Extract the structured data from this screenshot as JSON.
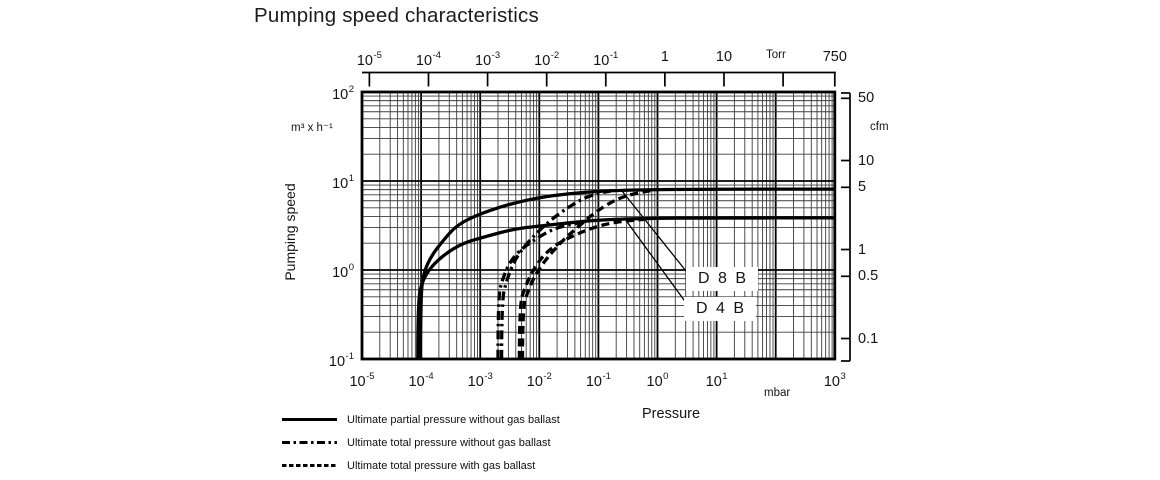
{
  "title": "Pumping speed characteristics",
  "axis_titles": {
    "x": "Pressure",
    "y": "Pumping speed"
  },
  "units": {
    "bottom": "mbar",
    "top": "Torr",
    "left": "m³ x h⁻¹",
    "right": "cfm"
  },
  "legend": {
    "items": [
      {
        "style": "solid",
        "label": "Ultimate partial pressure without gas ballast"
      },
      {
        "style": "dashdot",
        "label": "Ultimate total pressure without gas ballast"
      },
      {
        "style": "dotted",
        "label": "Ultimate total pressure with gas ballast"
      }
    ]
  },
  "chart_data": {
    "type": "line",
    "title": "Pumping speed characteristics",
    "xlabel": "Pressure",
    "ylabel": "Pumping speed",
    "x_scale": "log",
    "y_scale": "log",
    "x_range_mbar": [
      1e-05,
      1000
    ],
    "y_range_m3h": [
      0.1,
      100
    ],
    "grid": "log, major decades + minor lines",
    "x_axis_bottom": {
      "unit": "mbar",
      "ticks": [
        {
          "base": "10",
          "exp": "-5",
          "value": 1e-05
        },
        {
          "base": "10",
          "exp": "-4",
          "value": 0.0001
        },
        {
          "base": "10",
          "exp": "-3",
          "value": 0.001
        },
        {
          "base": "10",
          "exp": "-2",
          "value": 0.01
        },
        {
          "base": "10",
          "exp": "-1",
          "value": 0.1
        },
        {
          "base": "10",
          "exp": "0",
          "value": 1
        },
        {
          "base": "10",
          "exp": "1",
          "value": 10
        },
        {
          "base": "10",
          "exp": "3",
          "value": 1000
        }
      ]
    },
    "x_axis_top": {
      "unit": "Torr",
      "ticks": [
        {
          "base": "10",
          "exp": "-5",
          "value": 1e-05
        },
        {
          "base": "10",
          "exp": "-4",
          "value": 0.0001
        },
        {
          "base": "10",
          "exp": "-3",
          "value": 0.001
        },
        {
          "base": "10",
          "exp": "-2",
          "value": 0.01
        },
        {
          "base": "10",
          "exp": "-1",
          "value": 0.1
        },
        {
          "base": "1",
          "value": 1
        },
        {
          "base": "10",
          "value": 10
        },
        {
          "value": 100
        },
        {
          "base": "750",
          "value": 750
        }
      ]
    },
    "y_axis_left": {
      "unit": "m³ x h⁻¹",
      "ticks": [
        {
          "base": "10",
          "exp": "2",
          "value": 100
        },
        {
          "base": "10",
          "exp": "1",
          "value": 10
        },
        {
          "base": "10",
          "exp": "0",
          "value": 1
        },
        {
          "base": "10",
          "exp": "-1",
          "value": 0.1
        }
      ]
    },
    "y_axis_right": {
      "unit": "cfm",
      "ticks": [
        {
          "label": "50",
          "value": 50
        },
        {
          "label": "10",
          "value": 10
        },
        {
          "label": "5",
          "value": 5
        },
        {
          "label": "1",
          "value": 1
        },
        {
          "label": "0.5",
          "value": 0.5
        },
        {
          "label": "0.1",
          "value": 0.1
        }
      ]
    },
    "series": [
      {
        "name": "D 8 B ultimate partial pressure without gas ballast",
        "pump": "D 8 B",
        "style": "solid",
        "points_mbar_m3h": [
          [
            9.8e-05,
            0.1
          ],
          [
            9.8e-05,
            0.5
          ],
          [
            0.00011,
            0.93
          ],
          [
            0.00015,
            1.45
          ],
          [
            0.00023,
            2.1
          ],
          [
            0.0004,
            3.2
          ],
          [
            0.001,
            4.3
          ],
          [
            0.0031,
            5.5
          ],
          [
            0.012,
            6.7
          ],
          [
            0.048,
            7.4
          ],
          [
            0.23,
            7.9
          ],
          [
            5,
            8.1
          ],
          [
            1000,
            8.1
          ]
        ]
      },
      {
        "name": "D 4 B ultimate partial pressure without gas ballast",
        "pump": "D 4 B",
        "style": "solid",
        "points_mbar_m3h": [
          [
            8.8e-05,
            0.1
          ],
          [
            8.8e-05,
            0.45
          ],
          [
            0.000105,
            0.76
          ],
          [
            0.00015,
            1.1
          ],
          [
            0.00025,
            1.5
          ],
          [
            0.0005,
            2.0
          ],
          [
            0.0013,
            2.4
          ],
          [
            0.0038,
            2.9
          ],
          [
            0.015,
            3.2
          ],
          [
            0.07,
            3.6
          ],
          [
            0.5,
            3.8
          ],
          [
            10,
            3.85
          ],
          [
            1000,
            3.85
          ]
        ]
      },
      {
        "name": "D 8 B ultimate total pressure without gas ballast",
        "pump": "D 8 B",
        "style": "dashdot",
        "points_mbar_m3h": [
          [
            0.0023,
            0.1
          ],
          [
            0.0023,
            0.45
          ],
          [
            0.0028,
            0.76
          ],
          [
            0.0036,
            1.2
          ],
          [
            0.0054,
            1.8
          ],
          [
            0.009,
            2.6
          ],
          [
            0.016,
            3.7
          ],
          [
            0.03,
            5.0
          ],
          [
            0.056,
            6.4
          ],
          [
            0.1,
            7.3
          ],
          [
            0.16,
            7.7
          ]
        ]
      },
      {
        "name": "D 4 B ultimate total pressure without gas ballast",
        "pump": "D 4 B",
        "style": "dashdot",
        "points_mbar_m3h": [
          [
            0.002,
            0.1
          ],
          [
            0.002,
            0.5
          ],
          [
            0.0024,
            0.8
          ],
          [
            0.0031,
            1.2
          ],
          [
            0.0046,
            1.65
          ],
          [
            0.0076,
            2.1
          ],
          [
            0.014,
            2.7
          ],
          [
            0.024,
            3.1
          ],
          [
            0.04,
            3.3
          ],
          [
            0.06,
            3.5
          ]
        ]
      },
      {
        "name": "D 8 B ultimate total pressure with gas ballast",
        "pump": "D 8 B",
        "style": "dashed",
        "points_mbar_m3h": [
          [
            0.0052,
            0.1
          ],
          [
            0.0052,
            0.38
          ],
          [
            0.0065,
            0.59
          ],
          [
            0.0089,
            0.93
          ],
          [
            0.014,
            1.4
          ],
          [
            0.024,
            2.1
          ],
          [
            0.044,
            3.0
          ],
          [
            0.086,
            4.4
          ],
          [
            0.17,
            5.9
          ],
          [
            0.31,
            6.9
          ],
          [
            0.6,
            7.6
          ],
          [
            0.9,
            7.9
          ]
        ]
      },
      {
        "name": "D 4 B ultimate total pressure with gas ballast",
        "pump": "D 4 B",
        "style": "dashed",
        "points_mbar_m3h": [
          [
            0.0046,
            0.1
          ],
          [
            0.0046,
            0.4
          ],
          [
            0.0058,
            0.66
          ],
          [
            0.0079,
            1.0
          ],
          [
            0.012,
            1.5
          ],
          [
            0.021,
            2.0
          ],
          [
            0.041,
            2.5
          ],
          [
            0.082,
            3.0
          ],
          [
            0.17,
            3.4
          ],
          [
            0.34,
            3.6
          ],
          [
            0.6,
            3.7
          ]
        ]
      }
    ],
    "annotations": [
      {
        "label": "D 8 B"
      },
      {
        "label": "D 4 B"
      }
    ]
  }
}
